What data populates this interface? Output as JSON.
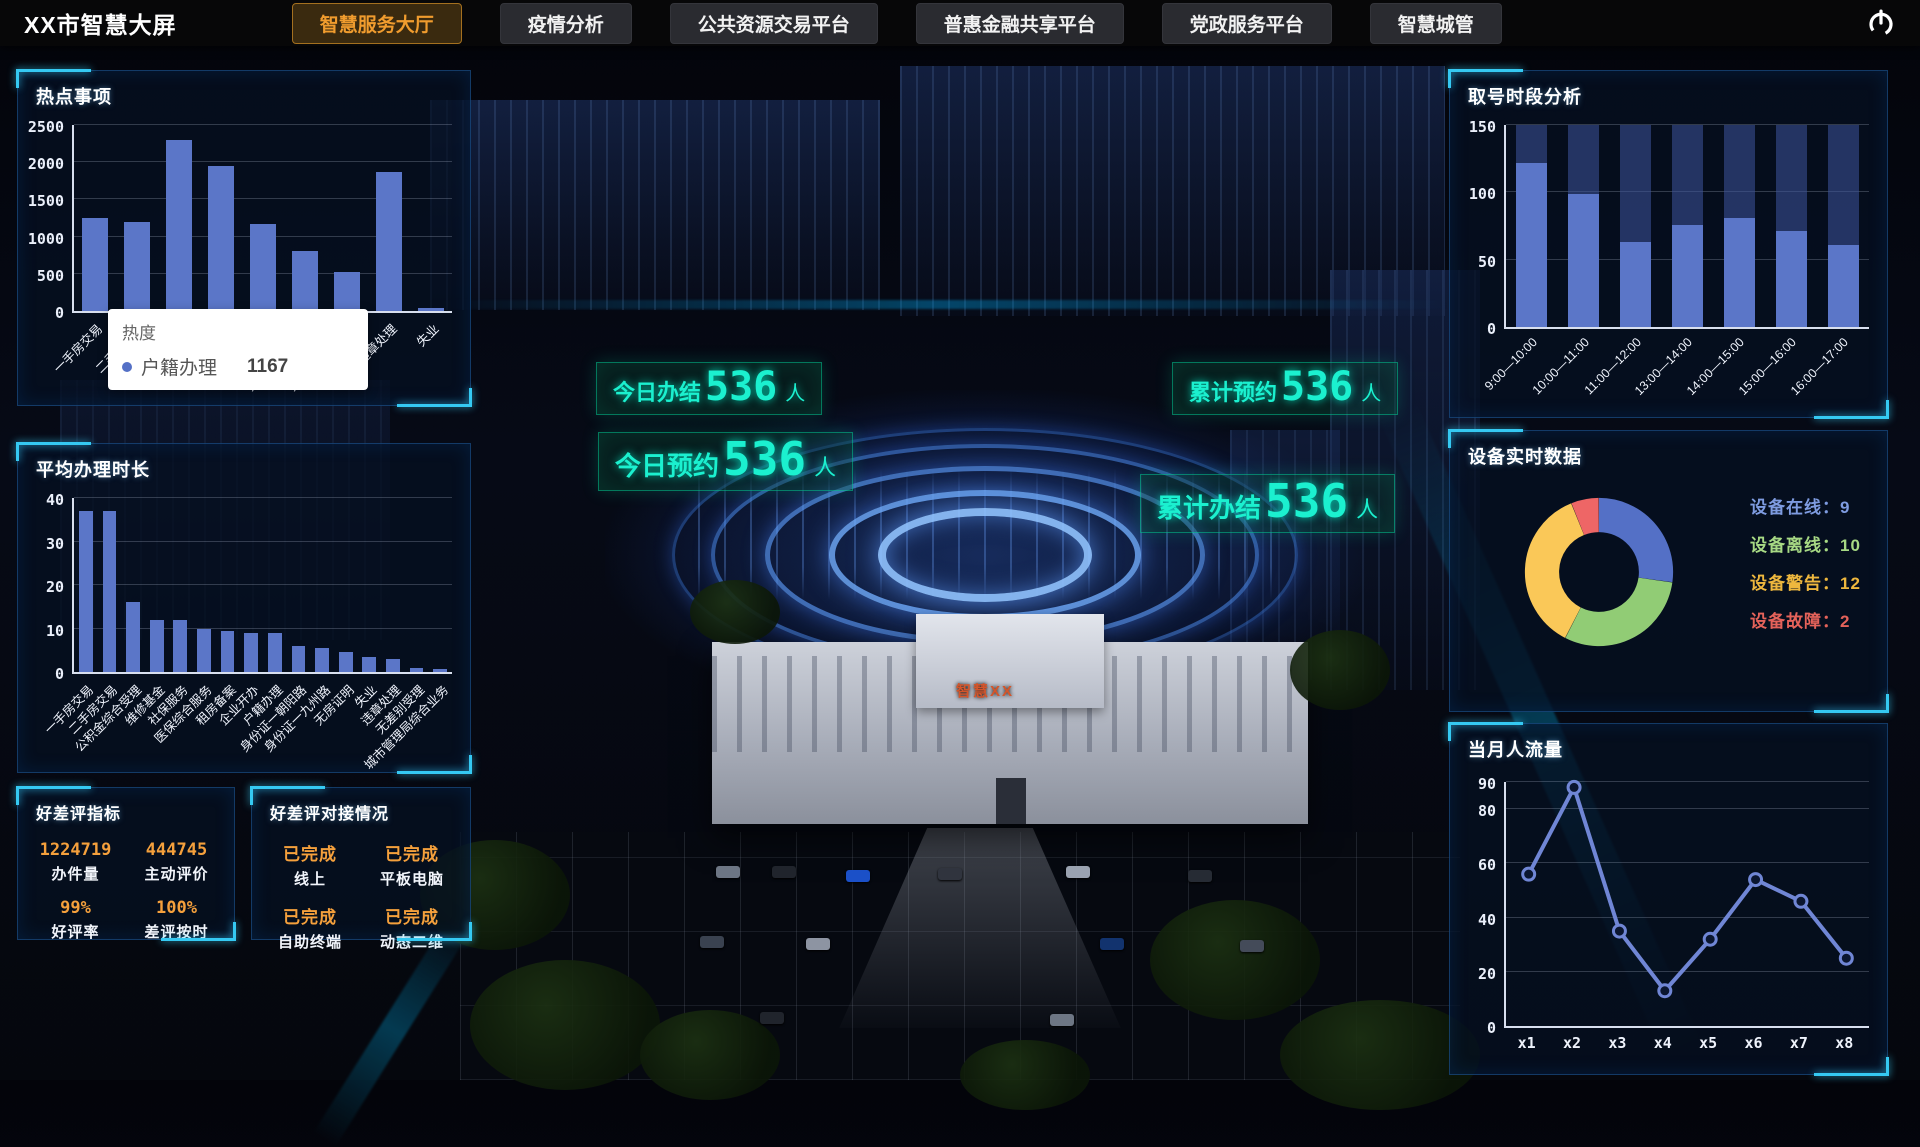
{
  "app": {
    "title": "XX市智慧大屏"
  },
  "nav": {
    "tabs": [
      {
        "label": "智慧服务大厅"
      },
      {
        "label": "疫情分析"
      },
      {
        "label": "公共资源交易平台"
      },
      {
        "label": "普惠金融共享平台"
      },
      {
        "label": "党政服务平台"
      },
      {
        "label": "智慧城管"
      }
    ]
  },
  "left": {
    "hot_title": "热点事项",
    "tooltip": {
      "title": "热度",
      "series": "户籍办理",
      "value": "1167"
    },
    "avg_title": "平均办理时长",
    "rating_metrics": {
      "title": "好差评指标",
      "stats": [
        {
          "value": "1224719",
          "label": "办件量"
        },
        {
          "value": "444745",
          "label": "主动评价"
        },
        {
          "value": "99%",
          "label": "好评率"
        },
        {
          "value": "100%",
          "label": "差评按时"
        }
      ]
    },
    "rating_integration": {
      "title": "好差评对接情况",
      "stats": [
        {
          "value": "已完成",
          "label": "线上"
        },
        {
          "value": "已完成",
          "label": "平板电脑"
        },
        {
          "value": "已完成",
          "label": "自助终端"
        },
        {
          "value": "已完成",
          "label": "动态二维"
        }
      ]
    }
  },
  "right": {
    "queue_title": "取号时段分析",
    "device_title": "设备实时数据",
    "device_stats": [
      {
        "label": "设备在线",
        "value": "9",
        "color": "#7e9be0"
      },
      {
        "label": "设备离线",
        "value": "10",
        "color": "#a7d984"
      },
      {
        "label": "设备警告",
        "value": "12",
        "color": "#eeb73e"
      },
      {
        "label": "设备故障",
        "value": "2",
        "color": "#e4625a"
      }
    ],
    "flow_title": "当月人流量"
  },
  "scene": {
    "stats": [
      {
        "label": "今日办结",
        "value": "536",
        "unit": "人"
      },
      {
        "label": "今日预约",
        "value": "536",
        "unit": "人"
      },
      {
        "label": "累计预约",
        "value": "536",
        "unit": "人"
      },
      {
        "label": "累计办结",
        "value": "536",
        "unit": "人"
      }
    ],
    "building_label": "智慧XX"
  },
  "chart_data": [
    {
      "id": "hot-items",
      "type": "bar",
      "title": "热点事项",
      "categories": [
        "一手房交易",
        "二手房交易",
        "医保综合服务",
        "社保服务",
        "户籍办理",
        "身份证一九州路",
        "身份证一朝阳路",
        "违章处理",
        "失业"
      ],
      "values": [
        1250,
        1200,
        2300,
        1950,
        1167,
        800,
        520,
        1870,
        40
      ],
      "ylim": [
        0,
        2500
      ],
      "yticks": [
        0,
        500,
        1000,
        1500,
        2000,
        2500
      ],
      "bar_color": "#5b76c8",
      "rotate_labels": true,
      "grid": true,
      "tooltip": {
        "title": "热度",
        "series": "户籍办理",
        "value": 1167,
        "marker_color": "#5470c6"
      }
    },
    {
      "id": "avg-time",
      "type": "bar",
      "title": "平均办理时长",
      "categories": [
        "一手房交易",
        "二手房交易",
        "公积金综合受理",
        "维修基金",
        "社保服务",
        "医保综合服务",
        "租房备案",
        "企业开办",
        "户籍办理",
        "身份证一朝阳路",
        "身份证一九州路",
        "无房证明",
        "失业",
        "违章处理",
        "无差别受理",
        "城市管理局综合业务"
      ],
      "values": [
        37,
        37,
        16,
        12,
        12,
        10,
        9.5,
        9,
        9,
        6,
        5.5,
        4.5,
        3.5,
        3,
        1,
        0.8
      ],
      "ylim": [
        0,
        40
      ],
      "yticks": [
        0,
        10,
        20,
        30,
        40
      ],
      "bar_color": "#5b76c8",
      "rotate_labels": true,
      "grid": true
    },
    {
      "id": "queue",
      "type": "bar",
      "title": "取号时段分析",
      "categories": [
        "9:00—10:00",
        "10:00—11:00",
        "11:00—12:00",
        "13:00—14:00",
        "14:00—15:00",
        "15:00—16:00",
        "16:00—17:00"
      ],
      "values": [
        122,
        99,
        63,
        76,
        81,
        71,
        61
      ],
      "stack_total": 150,
      "remainder_color": "rgba(62,86,158,0.55)",
      "ylim": [
        0,
        150
      ],
      "yticks": [
        0,
        50,
        100,
        150
      ],
      "bar_color": "#5b76c8",
      "rotate_labels": true,
      "grid": true
    },
    {
      "id": "device",
      "type": "pie",
      "title": "设备实时数据",
      "legend_position": "right",
      "labels": [
        "设备在线",
        "设备离线",
        "设备警告",
        "设备故障"
      ],
      "values": [
        9,
        10,
        12,
        2
      ],
      "colors": [
        "#5470c6",
        "#91cc75",
        "#fac858",
        "#ee6666"
      ]
    },
    {
      "id": "flow",
      "type": "line",
      "title": "当月人流量",
      "x": [
        "x1",
        "x2",
        "x3",
        "x4",
        "x5",
        "x6",
        "x7",
        "x8"
      ],
      "values": [
        56,
        88,
        35,
        13,
        32,
        54,
        46,
        25
      ],
      "ylim": [
        0,
        90
      ],
      "yticks": [
        0,
        20,
        40,
        60,
        80,
        90
      ],
      "line_color": "#7086d5",
      "grid": true
    }
  ]
}
